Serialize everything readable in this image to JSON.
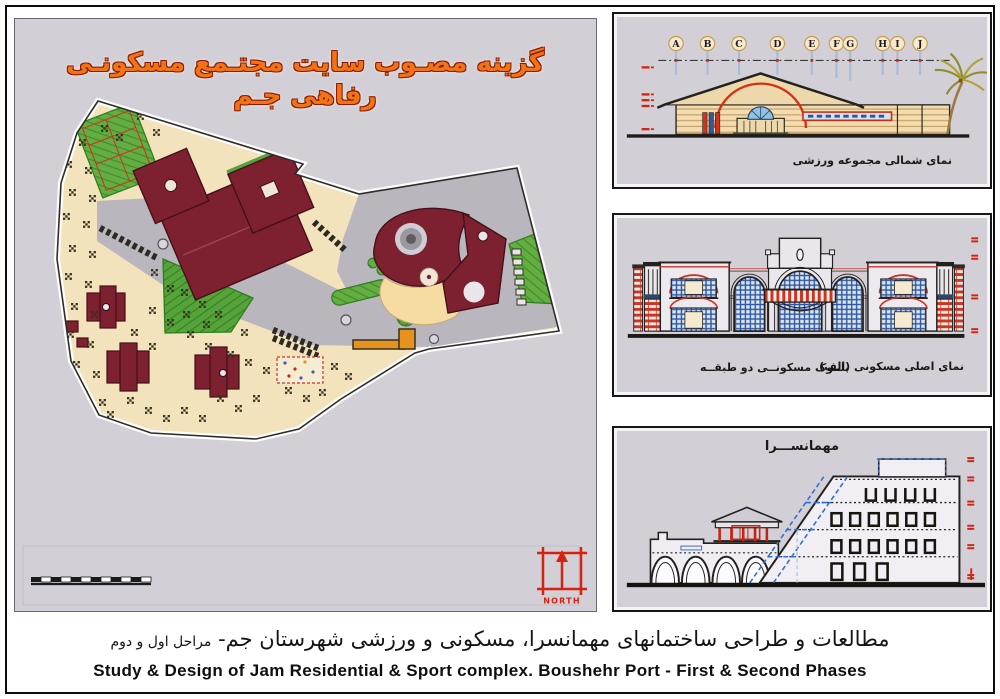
{
  "page": {
    "background": "#ffffff",
    "frame_color": "#0c0c0c"
  },
  "site_panel": {
    "title": "گزینه مصـوب سایت مجتـمع مسکونـی رفاهی جـم",
    "north_label": "NORTH"
  },
  "panels": {
    "sports": {
      "grid_letters": [
        "A",
        "B",
        "C",
        "D",
        "E",
        "F",
        "G",
        "H",
        "I",
        "J"
      ],
      "caption": "نمای شمالی مجموعه ورزشی"
    },
    "residential": {
      "caption_right": "نمای اصلی مسکونی (الف)",
      "caption_left": "بلــوک مسکونــی دو طبقــه"
    },
    "guesthouse": {
      "title": "مهمانســـرا"
    }
  },
  "footer": {
    "persian": "مطالعات و طراحی ساختمانهای مهمانسرا، مسکونی و ورزشی شهرستان جم-",
    "persian_small": "مراحل اول و دوم",
    "english": "Study & Design of Jam Residential & Sport complex. Boushehr Port - First & Second Phases"
  },
  "colors": {
    "panel_bg": "#d2cfd6",
    "maroon": "#7d2130",
    "green": "#57a33b",
    "ground_tan": "#f3e3bc",
    "road_gray": "#b9b6bd",
    "accent_red": "#cc2211",
    "accent_orange": "#e8921e",
    "grid_blue": "#2e55a0",
    "title_orange": "#f07416",
    "stair_blue": "#2f6fd0"
  }
}
